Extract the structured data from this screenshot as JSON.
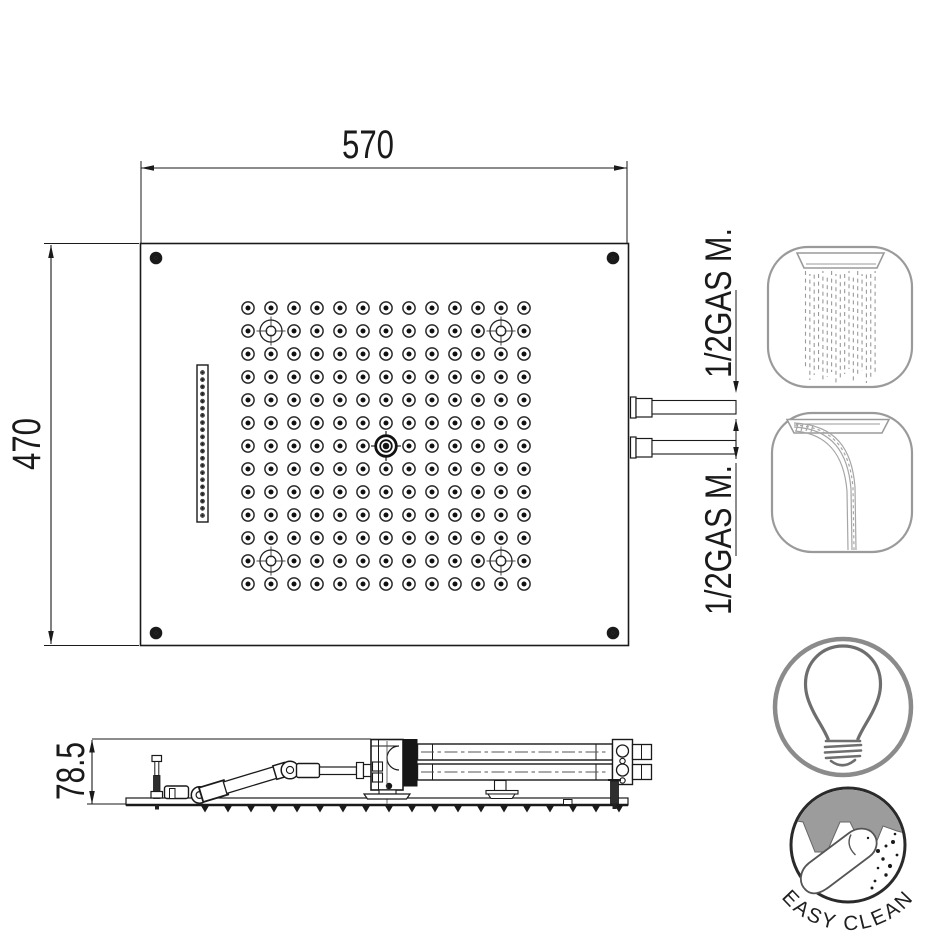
{
  "page": {
    "background": "#ffffff"
  },
  "top_view": {
    "width_label": "570",
    "height_label": "470",
    "connection_label_top": "1/2GAS M.",
    "connection_label_bottom": "1/2GAS M.",
    "nozzle_grid": {
      "cols": 13,
      "rows": 13
    },
    "slot_hole_count": 21,
    "corner_screw_count": 4
  },
  "side_view": {
    "height_label": "78.5",
    "nozzle_count": 19
  },
  "icons": {
    "rain": {
      "name": "rain-spray-icon",
      "stream_count": 17
    },
    "waterfall": {
      "name": "waterfall-icon"
    },
    "led": {
      "name": "light-bulb-icon"
    },
    "easy_clean": {
      "label": "EASY CLEAN"
    }
  },
  "colors": {
    "line": "#1a1a1a",
    "icon_stroke": "#9a9a9a",
    "bulb_circle": "#8b8b8b",
    "bulb_stroke": "#6e6e6e",
    "easy_clean_gray": "#9c9c9c",
    "dash": "#9a9a9a"
  }
}
